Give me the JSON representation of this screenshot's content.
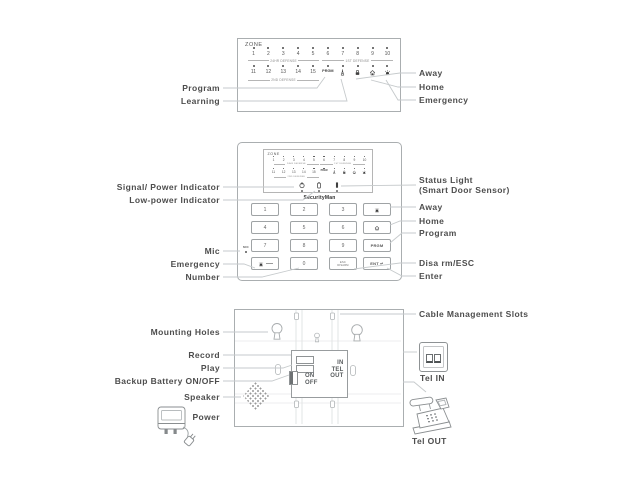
{
  "colors": {
    "leader_line": "#c6cacc",
    "panel_outline": "#aaaeb0",
    "label_text": "#4d4d4d",
    "icon_dark": "#3f3f3f"
  },
  "top_panel": {
    "zone_label": "ZONE",
    "row1": [
      "1",
      "2",
      "3",
      "4",
      "5",
      "6",
      "7",
      "8",
      "9",
      "10"
    ],
    "row2": [
      "11",
      "12",
      "13",
      "14",
      "15"
    ],
    "bracket_24hr": "24HR DEFENSE",
    "bracket_1st": "1ST DEFENSE",
    "bracket_2nd": "2ND DEFENSE",
    "prgm": "PRGM",
    "callouts": {
      "program": "Program",
      "learning": "Learning",
      "away": "Away",
      "home": "Home",
      "emergency": "Emergency"
    }
  },
  "keypad": {
    "zone_label": "ZONE",
    "row1": [
      "1",
      "2",
      "3",
      "4",
      "5",
      "6",
      "7",
      "8",
      "9",
      "10"
    ],
    "row2": [
      "11",
      "12",
      "13",
      "14",
      "15"
    ],
    "bracket_24hr": "24HR DEFENSE",
    "bracket_1st": "1ST DEFENSE",
    "bracket_2nd": "2ND DEFENSE",
    "prgm": "PRGM",
    "brand": "SecurityMan",
    "mic": "MIC",
    "digits": [
      "1",
      "2",
      "3",
      "4",
      "5",
      "6",
      "7",
      "8",
      "9"
    ],
    "zero": "0",
    "prgm_key": "PRGM",
    "esc_key": "ESC",
    "disarm_key": "DISARM",
    "ent_key": "ENT ↵",
    "callouts_left": {
      "signal": "Signal/ Power Indicator",
      "low_power": "Low-power Indicator",
      "mic": "Mic",
      "emergency": "Emergency",
      "number": "Number"
    },
    "callouts_right": {
      "status_line1": "Status Light",
      "status_line2": "(Smart Door Sensor)",
      "away": "Away",
      "home": "Home",
      "program": "Program",
      "disarm": "Disa rm/ESC",
      "enter": "Enter"
    }
  },
  "back_panel": {
    "on": "ON",
    "off": "OFF",
    "tel": [
      "IN",
      "TEL",
      "OUT"
    ],
    "callouts": {
      "mounting": "Mounting Holes",
      "record": "Record",
      "play": "Play",
      "backup_battery": "Backup Battery ON/OFF",
      "speaker": "Speaker",
      "power": "Power",
      "cable": "Cable Management Slots",
      "tel_in": "Tel IN",
      "tel_out": "Tel OUT"
    }
  },
  "icons": {
    "learning": "antenna-tower",
    "away": "padlock",
    "home": "house",
    "emergency": "siren-bell",
    "signal_power": "power-symbol",
    "low_power": "battery",
    "status_light": "led-bar",
    "enter_glyph": "↵"
  }
}
